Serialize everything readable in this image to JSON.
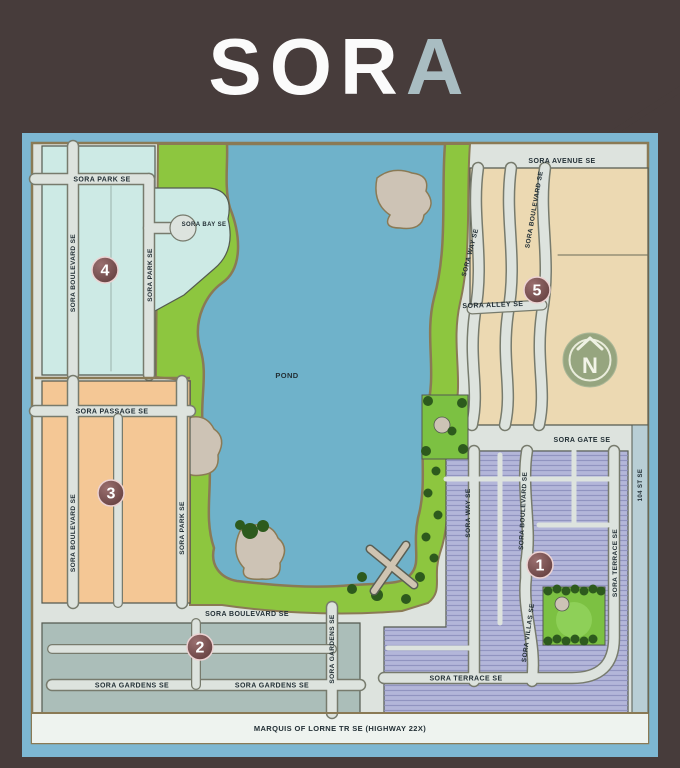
{
  "logo": {
    "main": "SOR",
    "accent": "A"
  },
  "map": {
    "pond_label": "POND",
    "north_label": "N",
    "highway_label": "MARQUIS OF LORNE TR SE (HIGHWAY 22X)",
    "phases": [
      {
        "number": "1",
        "area_color": "#b3b6d9"
      },
      {
        "number": "2",
        "area_color": "#abbeb9"
      },
      {
        "number": "3",
        "area_color": "#f4c795"
      },
      {
        "number": "4",
        "area_color": "#cdeae5"
      },
      {
        "number": "5",
        "area_color": "#ecd9b2"
      }
    ],
    "streets": {
      "area4_park_h": "SORA PARK SE",
      "area4_boulevard": "SORA BOULEVARD SE",
      "area4_park_v": "SORA PARK SE",
      "area4_bay": "SORA BAY SE",
      "area3_passage": "SORA PASSAGE SE",
      "area3_boulevard": "SORA BOULEVARD SE",
      "area3_park": "SORA PARK SE",
      "area2_boulevard": "SORA BOULEVARD SE",
      "area2_gardens_left": "SORA GARDENS SE",
      "area2_gardens_right": "SORA GARDENS SE",
      "area2_gardens_vert": "SORA GARDENS SE",
      "area5_avenue": "SORA AVENUE SE",
      "area5_way": "SORA WAY SE",
      "area5_boulevard": "SORA BOULEVARD SE",
      "area5_alley": "SORA ALLEY SE",
      "area1_gate": "SORA GATE SE",
      "area1_way": "SORA WAY SE",
      "area1_boulevard": "SORA BOULEVARD SE",
      "area1_terrace_vert": "SORA TERRACE SE",
      "area1_terrace_horiz": "SORA TERRACE SE",
      "area1_villas": "SORA VILLAS SE",
      "street_104": "104 ST SE",
      "highway": "MARQUIS OF LORNE TR SE (HIGHWAY 22X)"
    },
    "colors": {
      "background": "#473c3b",
      "frame": "#7db7d2",
      "road": "#dde3de",
      "outline": "#8a7a55",
      "pond": "#6fb2ca",
      "green": "#8dc63f",
      "beach": "#cdc3b5",
      "badge": "#6b4242",
      "north_circle": "#96a57f",
      "street_104_strip": "#b8ced5",
      "highway_strip": "#eef3ef"
    }
  }
}
